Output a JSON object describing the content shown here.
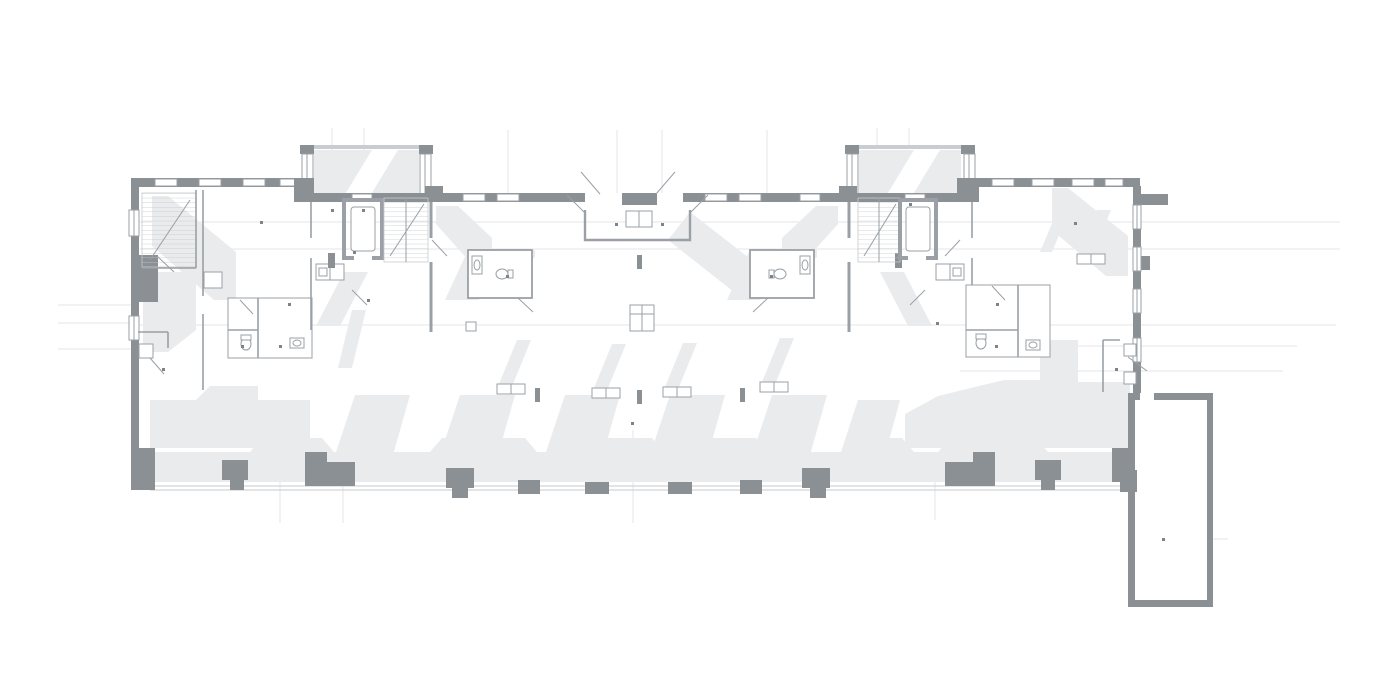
{
  "drawing": {
    "kind": "architectural-floor-plan",
    "style": "grayscale plan with cast shadows",
    "text_labels": [],
    "inventory": {
      "wings": [
        "left-wing",
        "right-wing"
      ],
      "stair_cores": [
        "stair-core-left",
        "stair-core-right"
      ],
      "stairs": [
        "emergency-stair-left",
        "main-stair-left",
        "main-stair-right"
      ],
      "elevators": [
        "elevator-left",
        "elevator-right"
      ],
      "entrance": "central-entrance-vestibule",
      "wc_pods": [
        "wc-pod-left",
        "wc-pod-right"
      ],
      "bath_suites": [
        "bath-suite-left-wing",
        "bath-suite-right-wing"
      ],
      "annex": "annex-room-south-east",
      "bay_windows": [
        "bay-window-left",
        "bay-window-right"
      ],
      "room_marker_dots": 21,
      "facade_piers": 13,
      "benches": 5
    }
  },
  "colors": {
    "background": "#ffffff",
    "wall": "#8b9095",
    "wall_light": "#c9ccd0",
    "shadow": "#e9ebed",
    "line": "#9aa0a5",
    "tread": "#c6cacd",
    "faint": "#e4e6e8",
    "dot": "#7e8387"
  }
}
